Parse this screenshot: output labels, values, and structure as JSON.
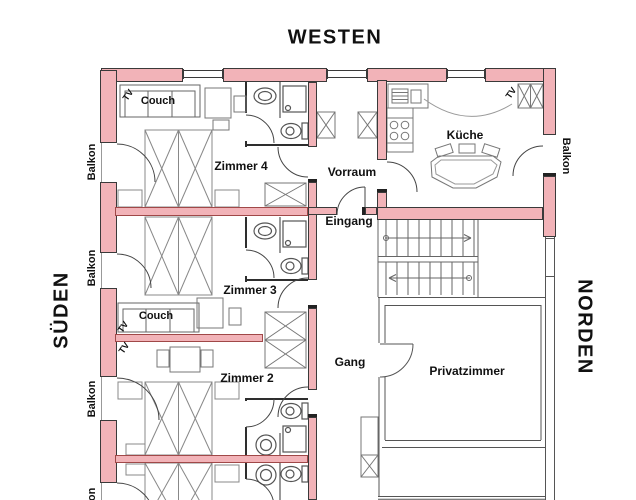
{
  "compass": {
    "west": "WESTEN",
    "south": "SÜDEN",
    "north": "NORDEN"
  },
  "balconies": {
    "left": [
      "Balkon",
      "Balkon",
      "Balkon",
      "Balkon"
    ],
    "right": [
      "Balkon"
    ]
  },
  "rooms": {
    "zimmer4": "Zimmer 4",
    "zimmer3": "Zimmer 3",
    "zimmer2": "Zimmer 2",
    "vorraum": "Vorraum",
    "eingang": "Eingang",
    "kueche": "Küche",
    "gang": "Gang",
    "privatzimmer": "Privatzimmer"
  },
  "furniture": {
    "couch": "Couch",
    "tv": "TV"
  },
  "colors": {
    "wall_fill": "#f2b3b8",
    "wall_border": "#3a3a3a",
    "divider_border": "#a04848",
    "text": "#111111"
  }
}
